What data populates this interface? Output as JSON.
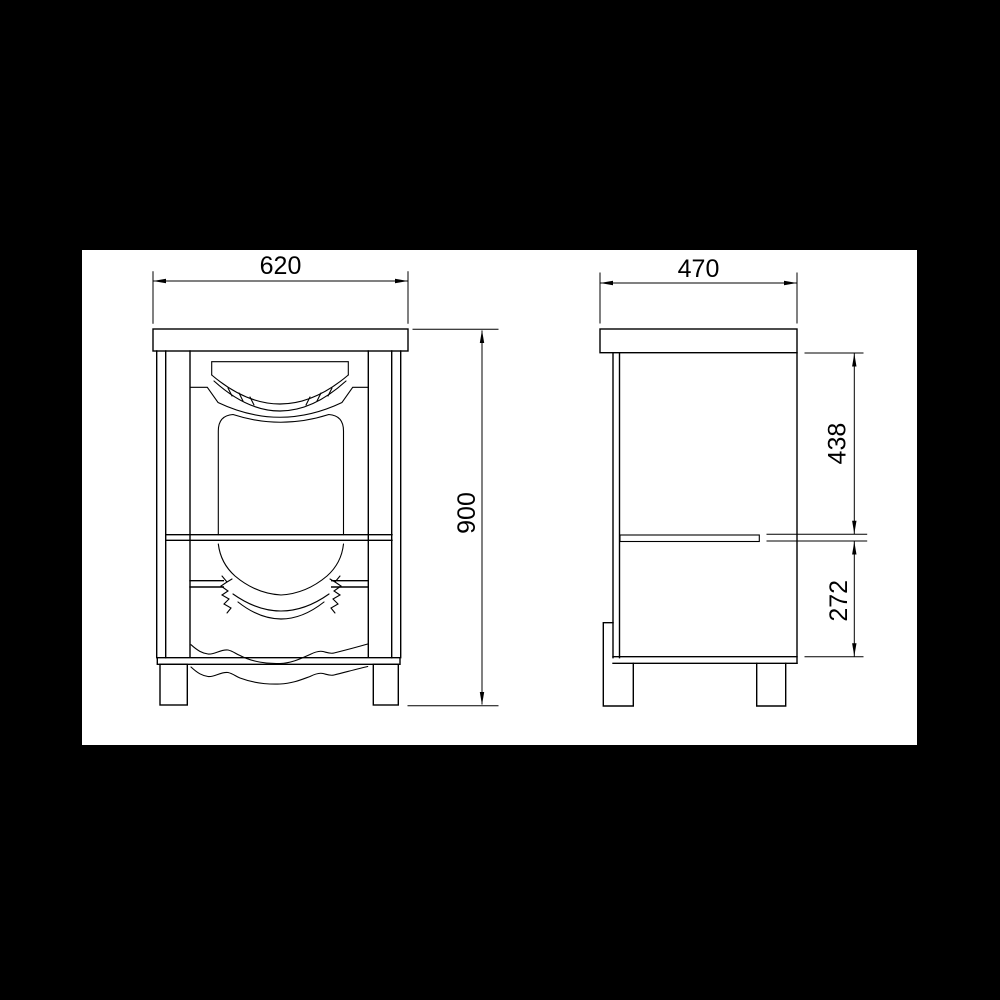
{
  "page": {
    "background_color": "#000000"
  },
  "paper": {
    "background_color": "#ffffff",
    "left": 82,
    "top": 250,
    "width": 835,
    "height": 495
  },
  "drawing": {
    "line_color": "#000000",
    "views": [
      {
        "id": "front-elevation"
      },
      {
        "id": "side-elevation"
      }
    ],
    "dimension_labels": {
      "front_width": "620",
      "front_height": "900",
      "side_depth": "470",
      "side_upper_height": "438",
      "side_lower_height": "272"
    }
  }
}
